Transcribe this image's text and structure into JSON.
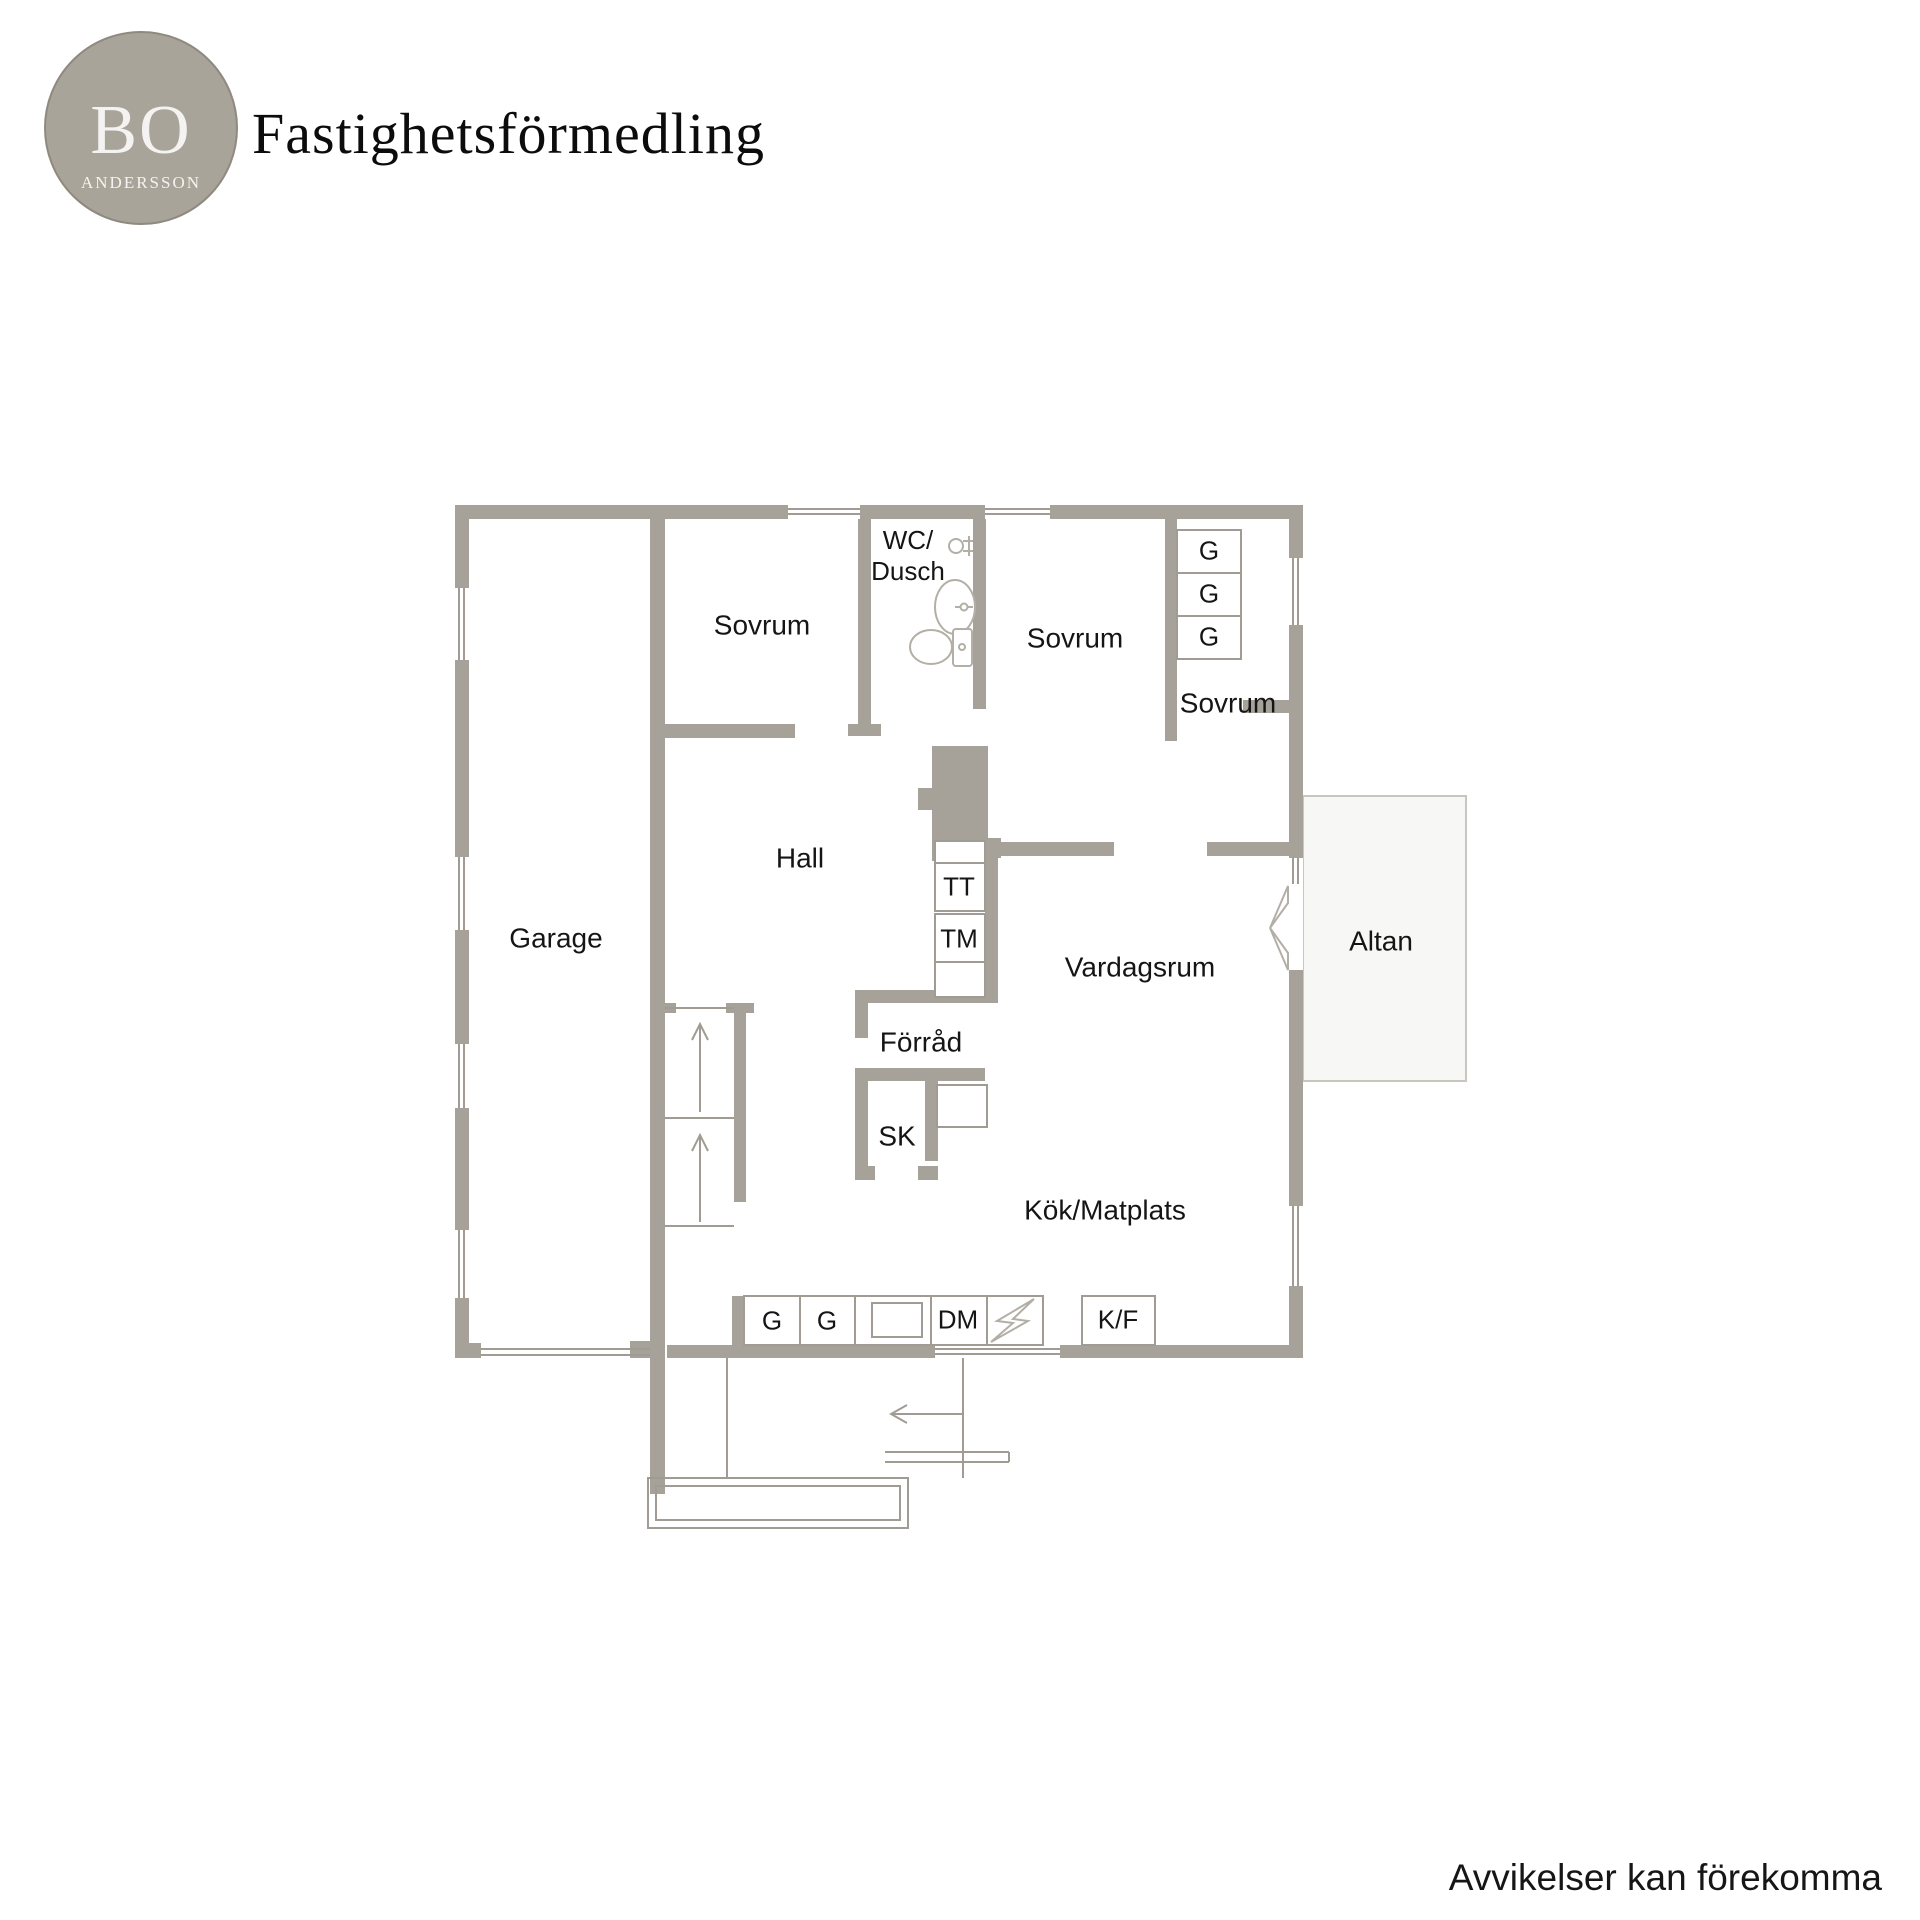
{
  "header": {
    "logo_top": "BO",
    "logo_bottom": "ANDERSSON",
    "company": "Fastighetsförmedling"
  },
  "floorplan": {
    "labels": {
      "garage": "Garage",
      "sovrum": "Sovrum",
      "wc_dusch": "WC/\nDusch",
      "hall": "Hall",
      "vardagsrum": "Vardagsrum",
      "forrad": "Förråd",
      "sk": "SK",
      "kok_matplats": "Kök/Matplats",
      "altan": "Altan",
      "g": "G",
      "tt": "TT",
      "tm": "TM",
      "dm": "DM",
      "kf": "K/F"
    }
  },
  "footer": {
    "disclaimer": "Avvikelser kan förekomma"
  },
  "colors": {
    "wall": "#a6a199",
    "thin": "#a19c93",
    "fixture": "#b3afa6",
    "panel": "#f7f7f6",
    "text": "#111111",
    "logo_bg": "#a9a49a"
  }
}
